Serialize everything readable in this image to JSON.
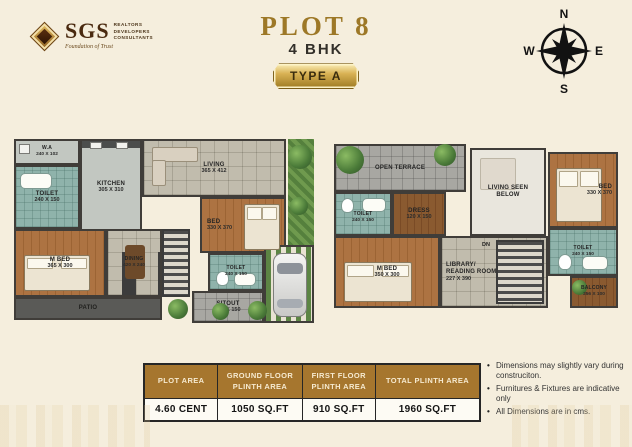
{
  "colors": {
    "accent_gold": "#9d7827",
    "table_header_bg": "#a6762e",
    "page_bg": "#f5eedd"
  },
  "logo": {
    "brand": "SGS",
    "line1": "REALTORS",
    "line2": "DEVELOPERS",
    "line3": "CONSULTANTS",
    "tagline": "Foundation of Trust"
  },
  "header": {
    "title": "PLOT 8",
    "subtitle": "4 BHK",
    "type_badge": "TYPE A"
  },
  "compass": {
    "north": "N",
    "east": "E",
    "south": "S",
    "west": "W"
  },
  "ground_floor": {
    "rooms": {
      "wa": {
        "label": "W.A",
        "dims": "240 X 102"
      },
      "kitchen": {
        "label": "KITCHEN",
        "dims": "305 X 310"
      },
      "living": {
        "label": "LIVING",
        "dims": "365 X 412"
      },
      "toilet_top": {
        "label": "TOILET",
        "dims": "240 X 150"
      },
      "m_bed": {
        "label": "M BED",
        "dims": "365 X 300"
      },
      "dining": {
        "label": "DINING",
        "dims": "420 X 240"
      },
      "bed": {
        "label": "BED",
        "dims": "330 X 370"
      },
      "toilet_bottom": {
        "label": "TOILET",
        "dims": "240 X 150"
      },
      "sitout": {
        "label": "SITOUT",
        "dims": "390 X 150"
      },
      "patio": {
        "label": "PATIO"
      }
    }
  },
  "first_floor": {
    "rooms": {
      "open_terrace": {
        "label": "OPEN TERRACE"
      },
      "toilet_left": {
        "label": "TOILET",
        "dims": "240 X 150"
      },
      "dress": {
        "label": "DRESS",
        "dims": "120 X 150"
      },
      "m_bed": {
        "label": "M BED",
        "dims": "350 X 300"
      },
      "living_seen_below": {
        "label": "LIVING SEEN BELOW"
      },
      "bed": {
        "label": "BED",
        "dims": "330 X 370"
      },
      "toilet_right": {
        "label": "TOILET",
        "dims": "240 X 150"
      },
      "library": {
        "label": "LIBRARY/ READING ROOM",
        "dims": "227 X 390"
      },
      "dn": {
        "label": "DN"
      },
      "balcony": {
        "label": "BALCONY",
        "dims": "256 X 100"
      }
    }
  },
  "area_table": {
    "headers": [
      "PLOT AREA",
      "GROUND FLOOR PLINTH AREA",
      "FIRST FLOOR PLINTH AREA",
      "TOTAL PLINTH AREA"
    ],
    "values": [
      "4.60 CENT",
      "1050 SQ.FT",
      "910 SQ.FT",
      "1960 SQ.FT"
    ]
  },
  "notes": [
    "Dimensions may slightly vary during construciton.",
    "Furnitures & Fixtures are indicative only",
    "All Dimensions are in cms."
  ]
}
